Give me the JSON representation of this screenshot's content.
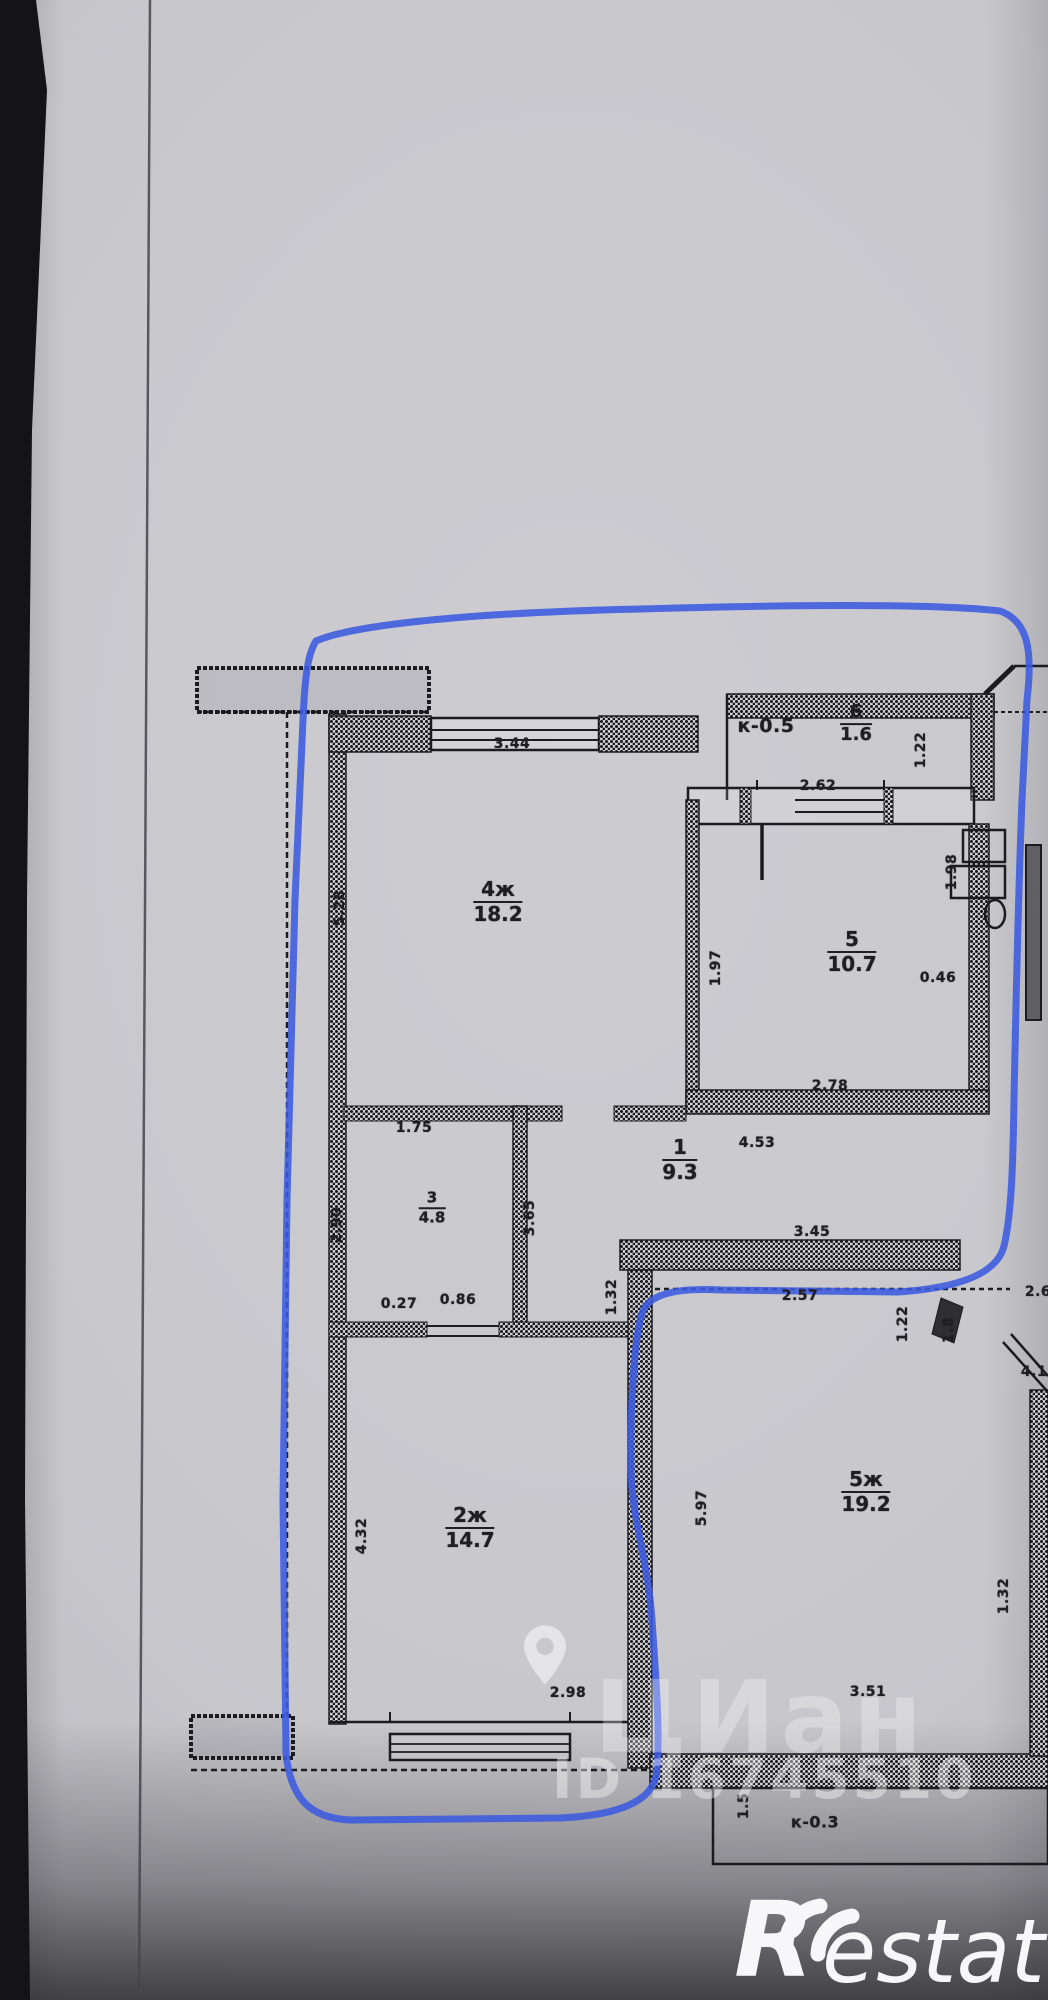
{
  "photo": {
    "paper_color": "#c8c8cd",
    "ink_color": "#1e1e23",
    "marker_color": "#3c5ae0",
    "watermark_color": "rgba(255,255,255,0.35)"
  },
  "watermark": {
    "brand": "ЦИан",
    "pin_icon": "location-pin-icon",
    "listing_id": "ID 16745510",
    "restate_r": "R",
    "restate_rest": "estate"
  },
  "floorplan": {
    "room_labels": [
      {
        "num": "6",
        "area": "1.6",
        "x": 856,
        "y": 724,
        "s": 18
      },
      {
        "num": "4ж",
        "area": "18.2",
        "x": 498,
        "y": 902,
        "s": 20
      },
      {
        "num": "5",
        "area": "10.7",
        "x": 852,
        "y": 952,
        "s": 20
      },
      {
        "num": "1",
        "area": "9.3",
        "x": 680,
        "y": 1160,
        "s": 20
      },
      {
        "num": "3",
        "area": "4.8",
        "x": 432,
        "y": 1208,
        "s": 15
      },
      {
        "num": "2ж",
        "area": "14.7",
        "x": 470,
        "y": 1528,
        "s": 20
      },
      {
        "num": "5ж",
        "area": "19.2",
        "x": 866,
        "y": 1492,
        "s": 20
      }
    ],
    "note_labels": [
      {
        "text": "к-0.5",
        "x": 766,
        "y": 726,
        "s": 19
      },
      {
        "text": "к-0.3",
        "x": 815,
        "y": 1822,
        "s": 16
      }
    ],
    "dim_labels": [
      {
        "t": "3.44",
        "x": 512,
        "y": 744
      },
      {
        "t": "2.62",
        "x": 818,
        "y": 786
      },
      {
        "t": "1.22",
        "x": 921,
        "y": 750,
        "r": 1
      },
      {
        "t": "5.28",
        "x": 340,
        "y": 908,
        "r": 1
      },
      {
        "t": "1.97",
        "x": 716,
        "y": 968,
        "r": 1
      },
      {
        "t": "1.98",
        "x": 952,
        "y": 872,
        "r": 1
      },
      {
        "t": "0.46",
        "x": 938,
        "y": 978
      },
      {
        "t": "2.78",
        "x": 830,
        "y": 1086
      },
      {
        "t": "4.53",
        "x": 757,
        "y": 1143
      },
      {
        "t": "3.45",
        "x": 812,
        "y": 1232
      },
      {
        "t": "1.75",
        "x": 414,
        "y": 1128
      },
      {
        "t": "2.90",
        "x": 337,
        "y": 1225,
        "r": 1
      },
      {
        "t": "3.65",
        "x": 530,
        "y": 1218,
        "r": 1
      },
      {
        "t": "0.27",
        "x": 399,
        "y": 1304
      },
      {
        "t": "0.86",
        "x": 458,
        "y": 1300
      },
      {
        "t": "1.32",
        "x": 612,
        "y": 1297,
        "r": 1
      },
      {
        "t": "2.57",
        "x": 800,
        "y": 1296
      },
      {
        "t": "1.22",
        "x": 903,
        "y": 1324,
        "r": 1
      },
      {
        "t": "1.8",
        "x": 949,
        "y": 1330,
        "r": 1
      },
      {
        "t": "2.6",
        "x": 1038,
        "y": 1292
      },
      {
        "t": "4.1",
        "x": 1034,
        "y": 1372
      },
      {
        "t": "4.32",
        "x": 362,
        "y": 1536,
        "r": 1
      },
      {
        "t": "5.97",
        "x": 702,
        "y": 1508,
        "r": 1
      },
      {
        "t": "1.32",
        "x": 1004,
        "y": 1596,
        "r": 1
      },
      {
        "t": "2.98",
        "x": 568,
        "y": 1693
      },
      {
        "t": "3.51",
        "x": 868,
        "y": 1692
      },
      {
        "t": "1.5",
        "x": 744,
        "y": 1806,
        "r": 1
      }
    ]
  }
}
